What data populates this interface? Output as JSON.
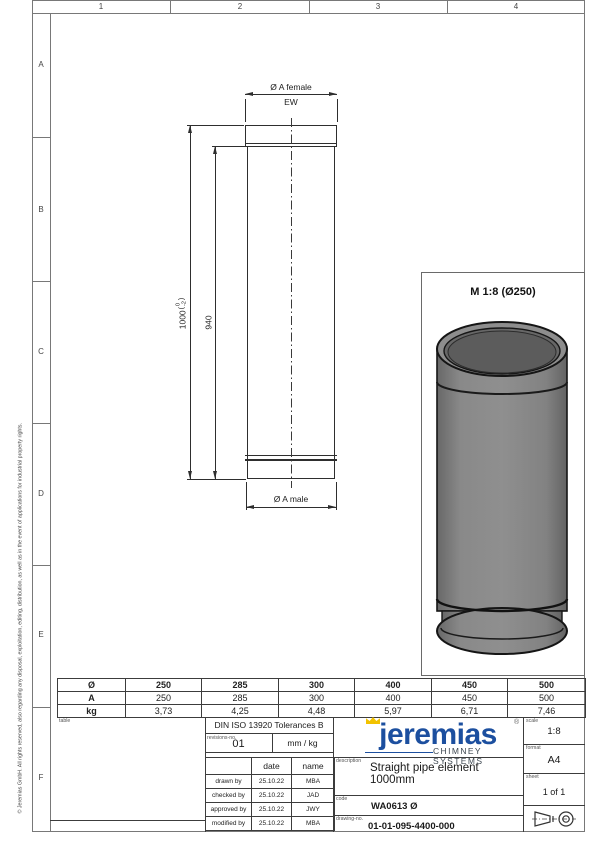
{
  "frame": {
    "column_labels": [
      "1",
      "2",
      "3",
      "4"
    ],
    "row_labels": [
      "A",
      "B",
      "C",
      "D",
      "E",
      "F"
    ],
    "copyright": "© Jeremias GmbH. All rights reserved, also regarding any disposal, exploitation, editing, distribution, as well as in the event of applications for industrial property rights."
  },
  "drawing": {
    "dim_female": "Ø A female",
    "dim_ew": "EW",
    "dim_length_base": "1000",
    "dim_length_tol_upper": "0",
    "dim_length_tol_lower": "-2",
    "dim_inner_length": "940",
    "dim_male": "Ø A male",
    "view_label": "M 1:8 (Ø250)"
  },
  "size_table": {
    "rows": [
      {
        "label": "Ø",
        "values": [
          "250",
          "285",
          "300",
          "400",
          "450",
          "500"
        ]
      },
      {
        "label": "A",
        "values": [
          "250",
          "285",
          "300",
          "400",
          "450",
          "500"
        ]
      },
      {
        "label": "kg",
        "values": [
          "3,73",
          "4,25",
          "4,48",
          "5,97",
          "6,71",
          "7,46"
        ]
      }
    ]
  },
  "title_block": {
    "table_label": "table",
    "tolerance": "DIN ISO 13920 Tolerances B",
    "revisions_label": "revisions-no.",
    "revision_no": "01",
    "units": "mm / kg",
    "sign_table": {
      "date_header": "date",
      "name_header": "name",
      "rows": [
        {
          "role": "drawn by",
          "date": "25.10.22",
          "name": "MBA"
        },
        {
          "role": "checked by",
          "date": "25.10.22",
          "name": "JAD"
        },
        {
          "role": "approved by",
          "date": "25.10.22",
          "name": "JWY"
        },
        {
          "role": "modified by",
          "date": "25.10.22",
          "name": "MBA"
        }
      ]
    },
    "logo": {
      "wordmark": "jeremias",
      "registered": "®",
      "subtitle": "CHIMNEY SYSTEMS",
      "blue": "#1c4f9f",
      "crown_yellow": "#f2c200"
    },
    "description_label": "description",
    "description": "Straight pipe element 1000mm",
    "code_label": "code",
    "code": "WA0613 Ø",
    "drawing_no_label": "drawing-no.",
    "drawing_no": "01-01-095-4400-000",
    "scale_label": "scale",
    "scale": "1:8",
    "format_label": "format",
    "format": "A4",
    "sheet_label": "sheet",
    "sheet": "1 of 1"
  }
}
